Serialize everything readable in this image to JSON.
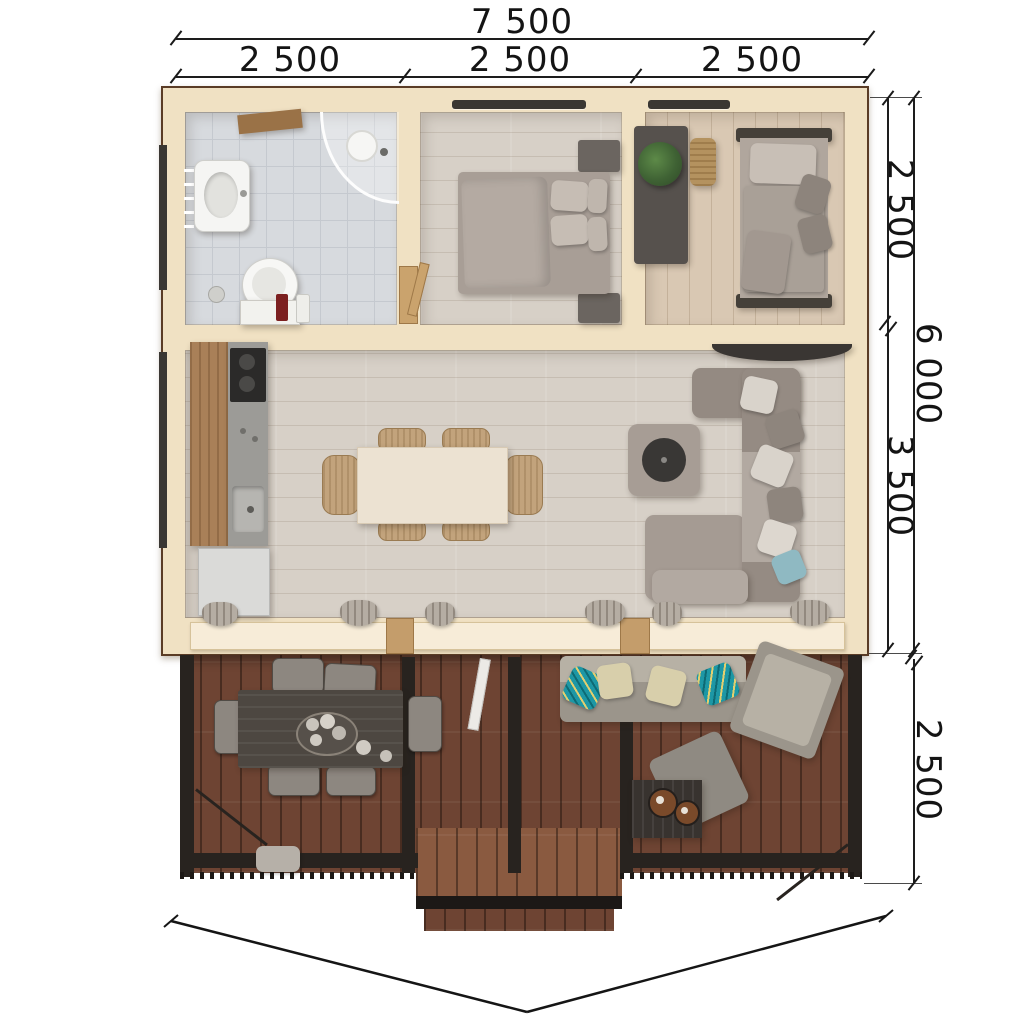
{
  "annotations": {
    "top": {
      "total": "7 500",
      "segments": [
        "2 500",
        "2 500",
        "2 500"
      ]
    },
    "right": {
      "upper_rooms": "2 500",
      "living_zone": "3 500",
      "overall_depth": "6 000",
      "terrace_depth": "2 500"
    }
  },
  "legend": {
    "areas": [
      "bathroom",
      "bedroom-1",
      "bedroom-2",
      "kitchen-living-room",
      "terrace"
    ]
  },
  "palette": {
    "wall_wood": "#f0e1c3",
    "roof_edge": "#5a3c26",
    "bath_tile": "#d7dade",
    "interior_floor": "#d7d0c7",
    "deck_wood": "#6e4433",
    "metal_frame": "#28231f",
    "upholstery": "#a89e96",
    "accent_teal": "#1f9aa8",
    "dimension_ink": "#1a1a1a"
  }
}
